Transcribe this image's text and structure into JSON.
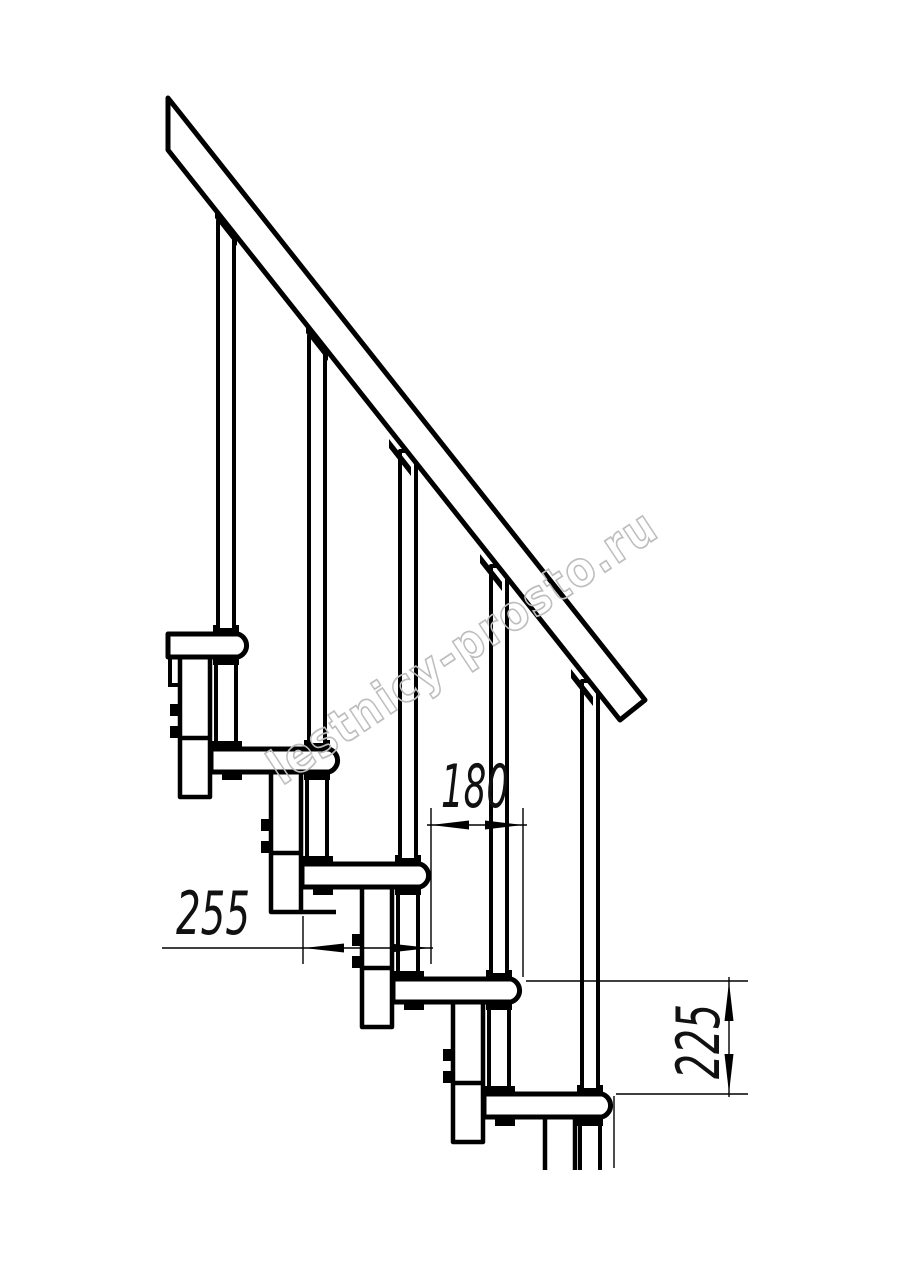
{
  "page": {
    "background": "#ffffff",
    "line_color": "#000000",
    "kind": "staircase side-view technical drawing"
  },
  "drawing": {
    "steps_visible": 5,
    "balusters_visible": 5,
    "dimensions": [
      {
        "id": "tread-depth",
        "label": "255",
        "orientation": "horizontal"
      },
      {
        "id": "going",
        "label": "180",
        "orientation": "horizontal"
      },
      {
        "id": "rise",
        "label": "225",
        "orientation": "vertical"
      }
    ],
    "dim_text_color": "#111111",
    "watermark": {
      "text": "lestnicy-prosto.ru",
      "color": "#bdbdbd"
    }
  }
}
